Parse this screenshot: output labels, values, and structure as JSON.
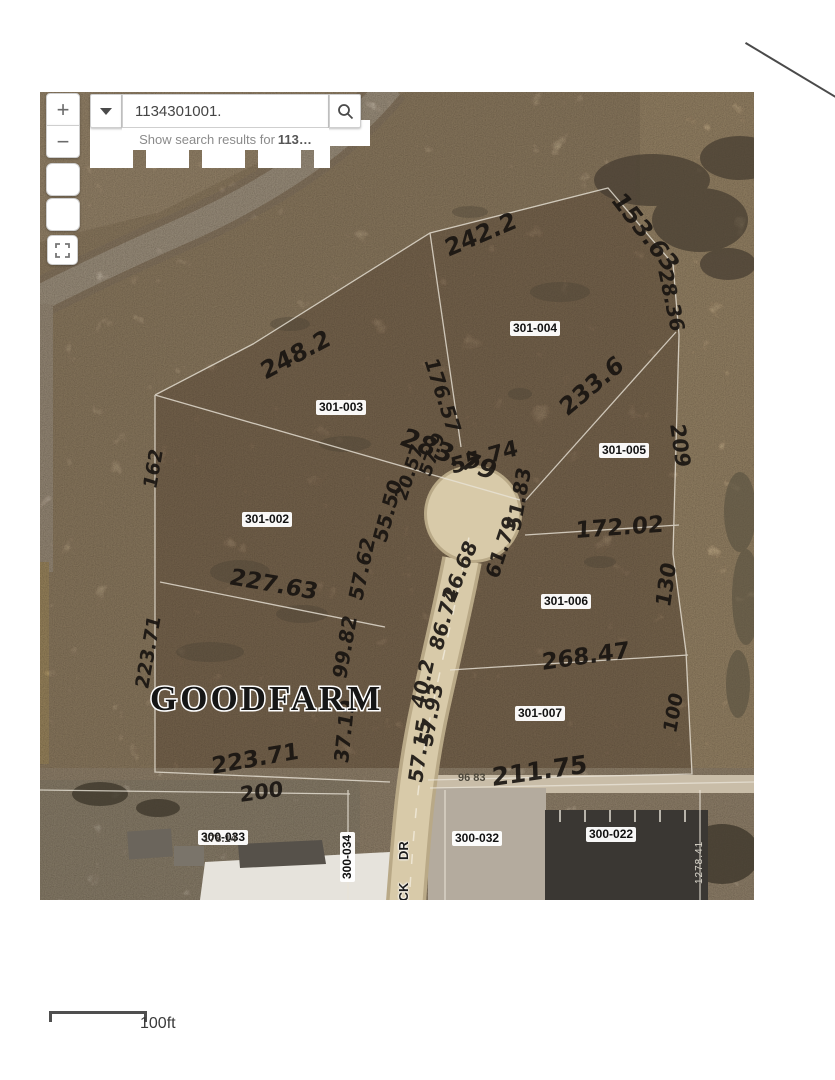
{
  "header": {
    "app_title": "Property Viewer",
    "region": "Grundy County, Illinois"
  },
  "search": {
    "value": "1134301001.",
    "clear_glyph": "✕",
    "suggestion_prefix": "Show search results for",
    "suggestion_term": "113…"
  },
  "controls": {
    "zoom_in": "+",
    "zoom_out": "−"
  },
  "scalebar": {
    "label": "100ft"
  },
  "colors": {
    "seal_navy": "#22354c",
    "handwriting": "#171310",
    "road_tan": "#d8caa9",
    "region_title_text": "#c4cfda"
  },
  "map": {
    "place_label": "GOODFARM",
    "street": {
      "part1": "DR",
      "part2": "ECK"
    },
    "parcels": {
      "p301_004": "301-004",
      "p301_003": "301-003",
      "p301_005": "301-005",
      "p301_002": "301-002",
      "p301_006": "301-006",
      "p301_007": "301-007",
      "p300_033": "300-033",
      "p300_034": "300-034",
      "p300_032": "300-032",
      "p300_022": "300-022"
    },
    "printed": {
      "dim_a": "96 83",
      "dim_b": "1278.41",
      "dim_c": "178.14"
    },
    "measurements": {
      "nw1": "248.2",
      "n1": "242.2",
      "ne1": "153.63",
      "ne2": "28.36",
      "e_diag": "233.6",
      "e1": "209",
      "mid_diag": "176.57",
      "w_diag": "283.79",
      "w1": "162",
      "cul_top": "55.74",
      "c1": "51.83",
      "c2": "61.79",
      "c3": "26.68",
      "c4": "86.74",
      "c5": "40.2",
      "c6": "57.93",
      "c7": "57.15",
      "e2": "172.02",
      "e3": "130",
      "se1": "268.47",
      "e4": "100",
      "s1": "211.75",
      "w2": "227.63",
      "w3": "223.71",
      "s2": "223.71",
      "s3": "200",
      "r1": "57.62",
      "r2": "55.50",
      "r3": "20.57",
      "r4": "57.9",
      "r5": "99.82",
      "r6": "37.19"
    }
  }
}
